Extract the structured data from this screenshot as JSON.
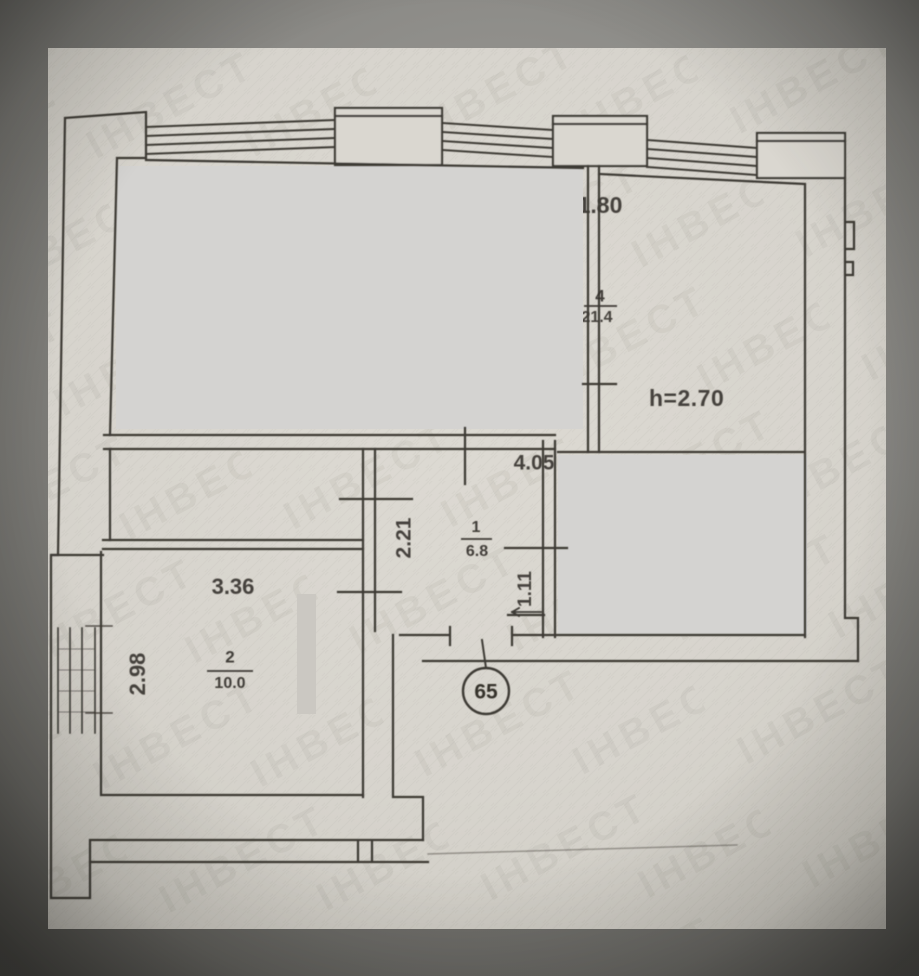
{
  "scene": {
    "description_colors": {
      "background": "#8b8a86",
      "paper": "#d9d6cf",
      "ink_line": "#3e3a34",
      "redaction_box": "#d4d3d1"
    },
    "watermark_text": "ІНВЕСТ"
  },
  "plan": {
    "unit_number": "65",
    "ceiling_height_label": "h=2.70",
    "rooms": [
      {
        "number": "4",
        "area": "21.4"
      },
      {
        "number": "1",
        "area": "6.8"
      },
      {
        "number": "2",
        "area": "10.0"
      }
    ],
    "dimensions": {
      "top_width": "1.80",
      "hall_width": "4.05",
      "hall_depth": "2.21",
      "door_offset": "1.11",
      "room2_width": "3.36",
      "room2_depth": "2.98"
    }
  }
}
